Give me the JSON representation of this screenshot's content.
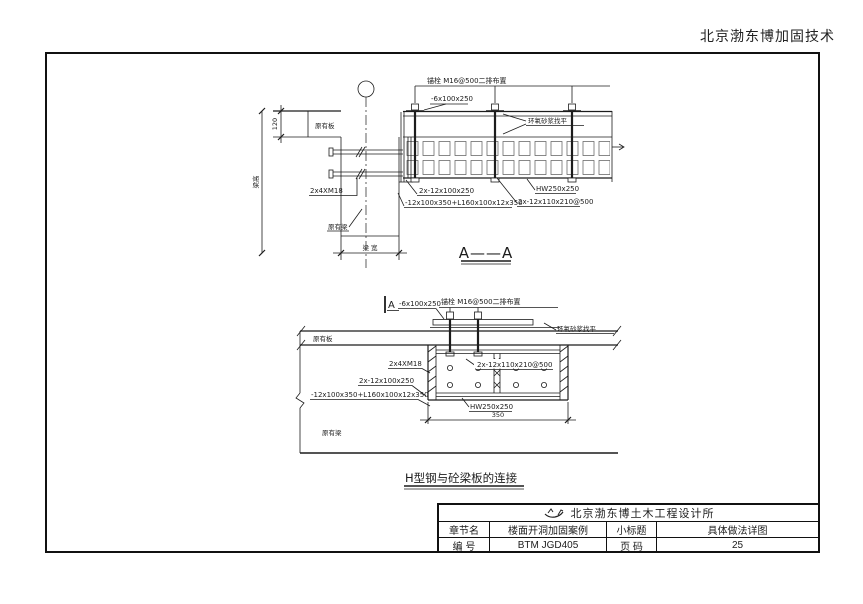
{
  "header": {
    "brand": "北京渤东博加固技术"
  },
  "detail_a": {
    "title": "A——A",
    "anchor_note": "锚栓 M16@500二排布置",
    "plate_label": "-6x100x250",
    "epoxy_label": "环氧砂浆找平",
    "existing_slab": "原有板",
    "existing_beam": "原有梁",
    "bolts_label": "2x4XM18",
    "double_plate_label": "2x-12x100x250",
    "angle_label": "-12x100x350+L160x100x12x350",
    "batten_label": "2x-12x110x210@500",
    "hsteel_label": "HW250x250",
    "dim_slab_thickness": "120",
    "dim_beam_height": "梁高",
    "dim_beam_width": "梁 宽"
  },
  "detail_b": {
    "title": "H型钢与砼梁板的连接",
    "section_marker": "A",
    "plate_label": "-6x100x250",
    "anchor_note": "锚栓 M16@500二排布置",
    "epoxy_label": "环氧砂浆找平",
    "existing_slab": "原有板",
    "existing_beam": "原有梁",
    "bolts_label": "2x4XM18",
    "batten_label": "2x-12x110x210@500",
    "double_plate_label": "2x-12x100x250",
    "angle_label": "-12x100x350+L160x100x12x350",
    "hsteel_label": "HW250x250",
    "dim_width": "350"
  },
  "title_block": {
    "company": "北京渤东博土木工程设计所",
    "row1_label1": "章节名",
    "row1_value1": "楼面开洞加固案例",
    "row1_label2": "小标题",
    "row1_value2": "具体做法详图",
    "row2_label1": "编  号",
    "row2_value1": "BTM JGD405",
    "row2_label2": "页  码",
    "row2_value2": "25"
  },
  "colors": {
    "ink": "#1c1c1c"
  }
}
